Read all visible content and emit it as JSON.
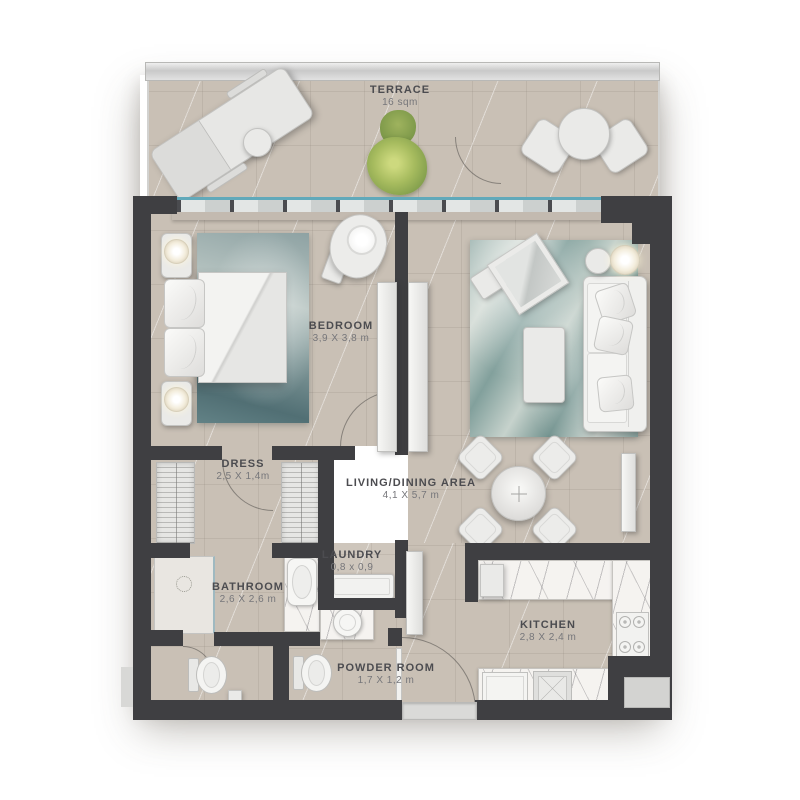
{
  "rooms": {
    "terrace": {
      "name": "TERRACE",
      "dims": "16 sqm"
    },
    "bedroom": {
      "name": "BEDROOM",
      "dims": "3,9 X 3,8 m"
    },
    "living": {
      "name": "LIVING/DINING AREA",
      "dims": "4,1 X 5,7 m"
    },
    "dress": {
      "name": "DRESS",
      "dims": "2,5 X 1,4m"
    },
    "bathroom": {
      "name": "BATHROOM",
      "dims": "2,6 X 2,6 m"
    },
    "laundry": {
      "name": "LAUNDRY",
      "dims": "0,8 x 0,9"
    },
    "powder": {
      "name": "POWDER ROOM",
      "dims": "1,7 X 1,2 m"
    },
    "kitchen": {
      "name": "KITCHEN",
      "dims": "2,8 X 2,4 m"
    }
  },
  "colors": {
    "wall": "#3f3f42",
    "floor_beige": "#c9c0b5",
    "glass_accent": "#61a9ba",
    "bedroom_rug_teal": "#7e9697",
    "living_rug_teal": "#8aa6a2",
    "plant_green": "#93ad52",
    "counter_marble": "#f5f3f0",
    "label_text": "#4c4c50"
  }
}
